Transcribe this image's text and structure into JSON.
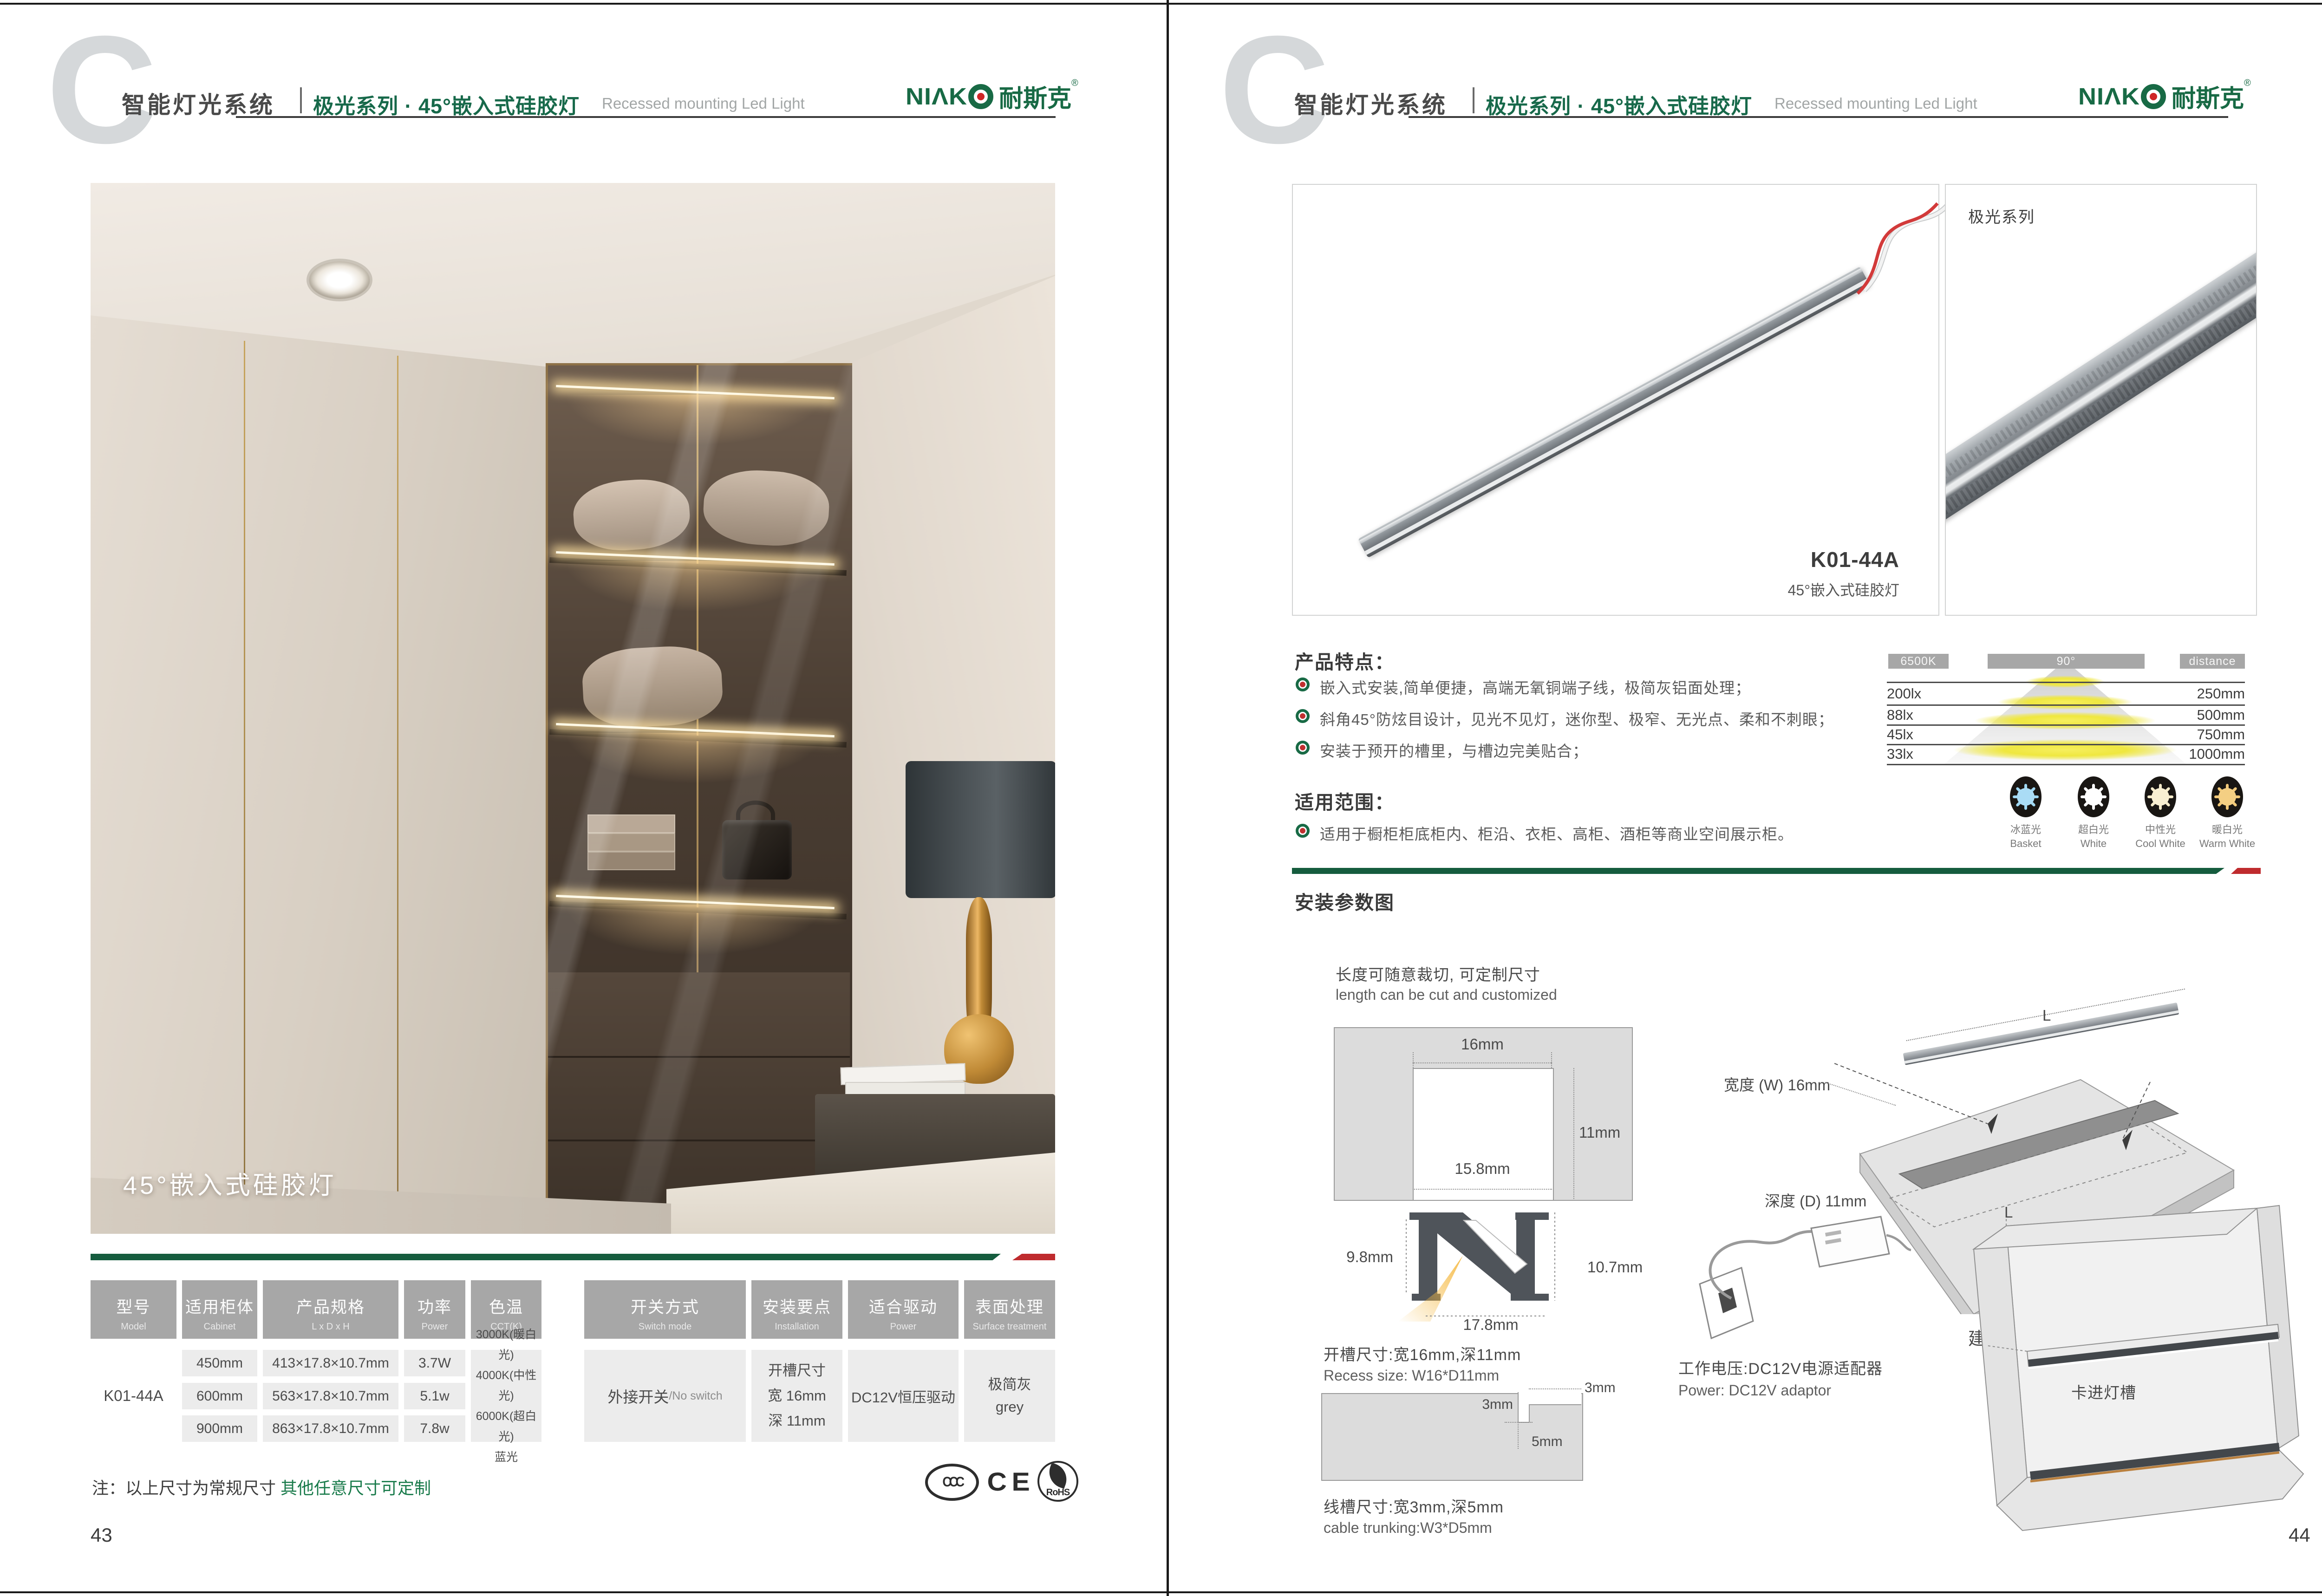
{
  "brand": {
    "logo_latin": "NIΛK",
    "logo_cn": "耐斯克",
    "registered": "®"
  },
  "header": {
    "title_cn": "智能灯光系统",
    "subtitle_cn": "极光系列 · 45°嵌入式硅胶灯",
    "subtitle_en": "Recessed mounting Led Light"
  },
  "left_page": {
    "photo_caption": "45°嵌入式硅胶灯",
    "table": {
      "headers": [
        {
          "cn": "型号",
          "en": "Model"
        },
        {
          "cn": "适用柜体",
          "en": "Cabinet"
        },
        {
          "cn": "产品规格",
          "en": "L x D x H"
        },
        {
          "cn": "功率",
          "en": "Power"
        },
        {
          "cn": "色温",
          "en": "CCT(K)"
        },
        {
          "cn": "开关方式",
          "en": "Switch mode"
        },
        {
          "cn": "安装要点",
          "en": "Installation"
        },
        {
          "cn": "适合驱动",
          "en": "Power"
        },
        {
          "cn": "表面处理",
          "en": "Surface treatment"
        }
      ],
      "model": "K01-44A",
      "rows": [
        {
          "cabinet": "450mm",
          "spec": "413×17.8×10.7mm",
          "power": "3.7W"
        },
        {
          "cabinet": "600mm",
          "spec": "563×17.8×10.7mm",
          "power": "5.1w"
        },
        {
          "cabinet": "900mm",
          "spec": "863×17.8×10.7mm",
          "power": "7.8w"
        }
      ],
      "cct": [
        "3000K(暖白光)",
        "4000K(中性光)",
        "6000K(超白光)",
        "蓝光"
      ],
      "switch_cn": "外接开关",
      "switch_en": "/No switch",
      "install": [
        "开槽尺寸",
        "宽 16mm",
        "深 11mm"
      ],
      "driver": "DC12V恒压驱动",
      "surface": [
        "极简灰",
        "grey"
      ]
    },
    "note_prefix": "注：以上尺寸为常规尺寸 ",
    "note_green": "其他任意尺寸可定制",
    "certs": {
      "ccc": "CCC",
      "ce": "CE",
      "rohs": "RoHS"
    },
    "page_number": "43"
  },
  "right_page": {
    "series_label": "极光系列",
    "product_code": "K01-44A",
    "product_name": "45°嵌入式硅胶灯",
    "features_heading": "产品特点：",
    "features": [
      "嵌入式安装,简单便捷，高端无氧铜端子线，极简灰铝面处理；",
      "斜角45°防炫目设计，见光不见灯，迷你型、极窄、无光点、柔和不刺眼；",
      "安装于预开的槽里，与槽边完美贴合；"
    ],
    "scope_heading": "适用范围：",
    "scope": [
      "适用于橱柜柜底柜内、柜沿、衣柜、高柜、酒柜等商业空间展示柜。"
    ],
    "photometry": {
      "type": "table",
      "cct": "6500K",
      "angle": "90°",
      "distance_label": "distance",
      "rows": [
        {
          "lux": "200lx",
          "mm": "250mm"
        },
        {
          "lux": "88lx",
          "mm": "500mm"
        },
        {
          "lux": "45lx",
          "mm": "750mm"
        },
        {
          "lux": "33lx",
          "mm": "1000mm"
        }
      ],
      "lamps": [
        {
          "cn": "冰蓝光",
          "en": "Basket"
        },
        {
          "cn": "超白光",
          "en": "White"
        },
        {
          "cn": "中性光",
          "en": "Cool White"
        },
        {
          "cn": "暖白光",
          "en": "Warm White"
        }
      ]
    },
    "install_heading": "安装参数图",
    "cut_note_cn": "长度可随意裁切, 可定制尺寸",
    "cut_note_en": "length can be cut and customized",
    "groove_dims": {
      "top": "16mm",
      "depth": "11mm",
      "bottom": "15.8mm"
    },
    "profile_dims": {
      "left": "9.8mm",
      "right": "10.7mm",
      "bottom": "17.8mm"
    },
    "recess_cn": "开槽尺寸:宽16mm,深11mm",
    "recess_en": "Recess size: W16*D11mm",
    "trunk_dims": {
      "top": "3mm",
      "width": "3mm",
      "depth": "5mm"
    },
    "trunk_cn": "线槽尺寸:宽3mm,深5mm",
    "trunk_en": "cable trunking:W3*D5mm",
    "board": {
      "l_top": "L",
      "l_groove": "L",
      "width_label": "宽度 (W) 16mm",
      "depth_label": "深度 (D) 11mm",
      "caption": "建议开槽尺寸"
    },
    "power_cn": "工作电压:DC12V电源适配器",
    "power_en": "Power: DC12V adaptor",
    "clip_label": "卡进灯槽",
    "page_number": "44"
  }
}
